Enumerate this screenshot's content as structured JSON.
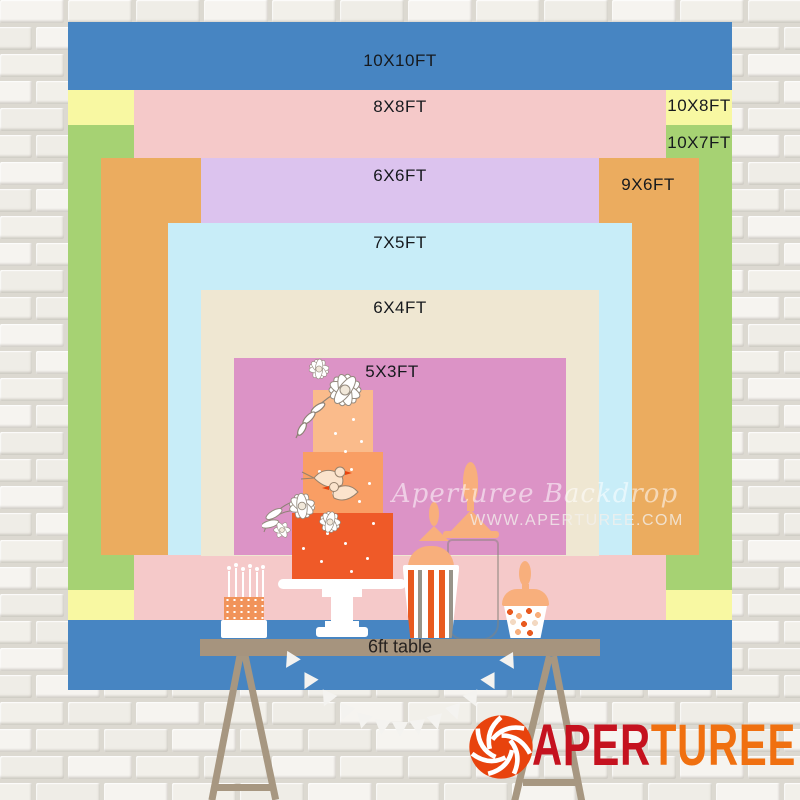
{
  "backdrop": {
    "description": "nested backdrop size chart",
    "layers": [
      {
        "label": "10X10FT",
        "color": "#4785C2",
        "x": 68,
        "y": 22,
        "w": 664,
        "h": 668,
        "lx": 400,
        "ly": 61
      },
      {
        "label": "10X8FT",
        "color": "#F8F8A2",
        "x": 68,
        "y": 90,
        "w": 664,
        "h": 530,
        "lx": 699,
        "ly": 106
      },
      {
        "label": "10X7FT",
        "color": "#A6D273",
        "x": 68,
        "y": 125,
        "w": 664,
        "h": 465,
        "lx": 699,
        "ly": 143
      },
      {
        "label": "8X8FT",
        "color": "#F5C9C9",
        "x": 134,
        "y": 90,
        "w": 532,
        "h": 530,
        "lx": 400,
        "ly": 107
      },
      {
        "label": "9X6FT",
        "color": "#EBAC5F",
        "x": 101,
        "y": 158,
        "w": 598,
        "h": 397,
        "lx": 648,
        "ly": 185
      },
      {
        "label": "6X6FT",
        "color": "#DCC3EE",
        "x": 201,
        "y": 158,
        "w": 398,
        "h": 398,
        "lx": 400,
        "ly": 176
      },
      {
        "label": "7X5FT",
        "color": "#C8EDF8",
        "x": 168,
        "y": 223,
        "w": 464,
        "h": 332,
        "lx": 400,
        "ly": 243
      },
      {
        "label": "6X4FT",
        "color": "#EFE7D2",
        "x": 201,
        "y": 290,
        "w": 398,
        "h": 266,
        "lx": 400,
        "ly": 308
      },
      {
        "label": "5X3FT",
        "color": "#DC93C6",
        "x": 234,
        "y": 358,
        "w": 332,
        "h": 197,
        "lx": 392,
        "ly": 372
      }
    ]
  },
  "table": {
    "label": "6ft table"
  },
  "watermark": {
    "line1": "Aperturee Backdrop",
    "line2": "WWW.APERTUREE.COM"
  },
  "brand": {
    "name_part1": "APER",
    "name_part2": "TUREE",
    "red": "#C5121F",
    "orange": "#F07010",
    "icon_color": "#E8430D"
  }
}
